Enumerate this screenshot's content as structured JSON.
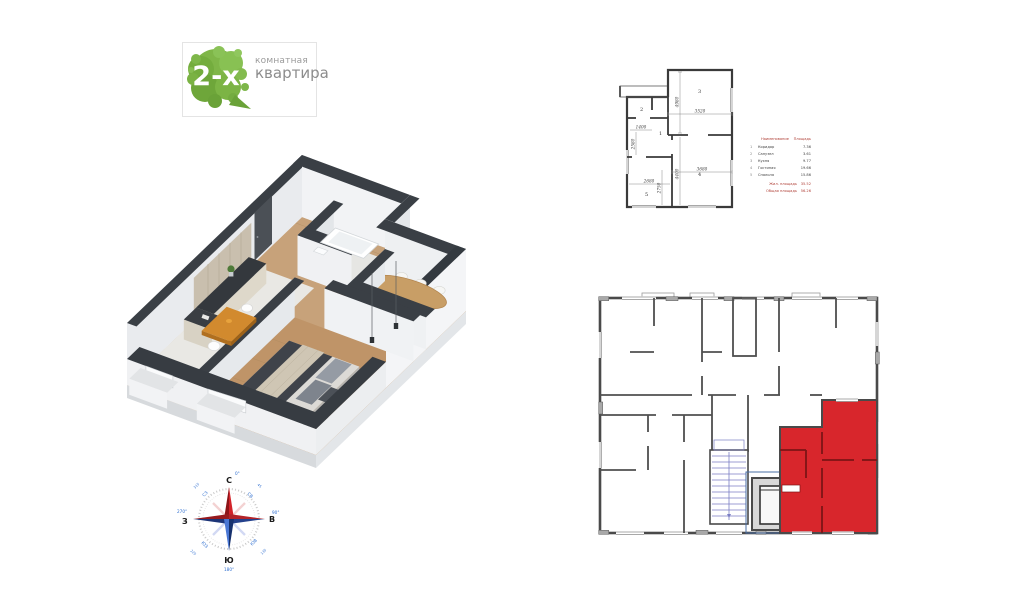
{
  "badge": {
    "count": "2-х",
    "type_line1": "комнатная",
    "type_line2": "квартира"
  },
  "plan2d": {
    "rooms": {
      "hall": "1",
      "bath": "2",
      "kitchen": "3",
      "living": "4",
      "bedroom": "5"
    },
    "dims": {
      "top_width": "3520",
      "room3_height": "4980",
      "hall_width": "1400",
      "hall_height": "2580",
      "room4_width": "3680",
      "room4_height": "4400",
      "room5_width": "2680",
      "room5_height": "2750"
    }
  },
  "legend": {
    "header": {
      "name": "Наименование",
      "area": "Площадь"
    },
    "rows": [
      {
        "num": "1",
        "name": "Коридор",
        "area": "7.36"
      },
      {
        "num": "2",
        "name": "Санузел",
        "area": "3.61"
      },
      {
        "num": "3",
        "name": "Кухня",
        "area": "9.77"
      },
      {
        "num": "4",
        "name": "Гостиная",
        "area": "19.66"
      },
      {
        "num": "5",
        "name": "Спальня",
        "area": "15.86"
      }
    ],
    "totals": [
      {
        "label": "Жил. площадь",
        "value": "35.52"
      },
      {
        "label": "Общая площадь",
        "value": "56.26"
      }
    ]
  },
  "compass": {
    "n": "С",
    "e": "В",
    "s": "Ю",
    "w": "З",
    "deg_n": "0°",
    "deg_e": "90°",
    "deg_s": "180°",
    "deg_w": "270°",
    "ne": "СВ",
    "se": "ЮВ",
    "sw": "ЮЗ",
    "nw": "СЗ",
    "deg_ne": "45",
    "deg_se": "135",
    "deg_sw": "225",
    "deg_nw": "315"
  },
  "colors": {
    "accent_red": "#d8262c",
    "leaf_green": "#76b043",
    "wall_dark": "#3a3f45",
    "compass_red": "#c4161c",
    "compass_blue": "#1f4fa0",
    "stairs_blue": "#6a6db8"
  }
}
